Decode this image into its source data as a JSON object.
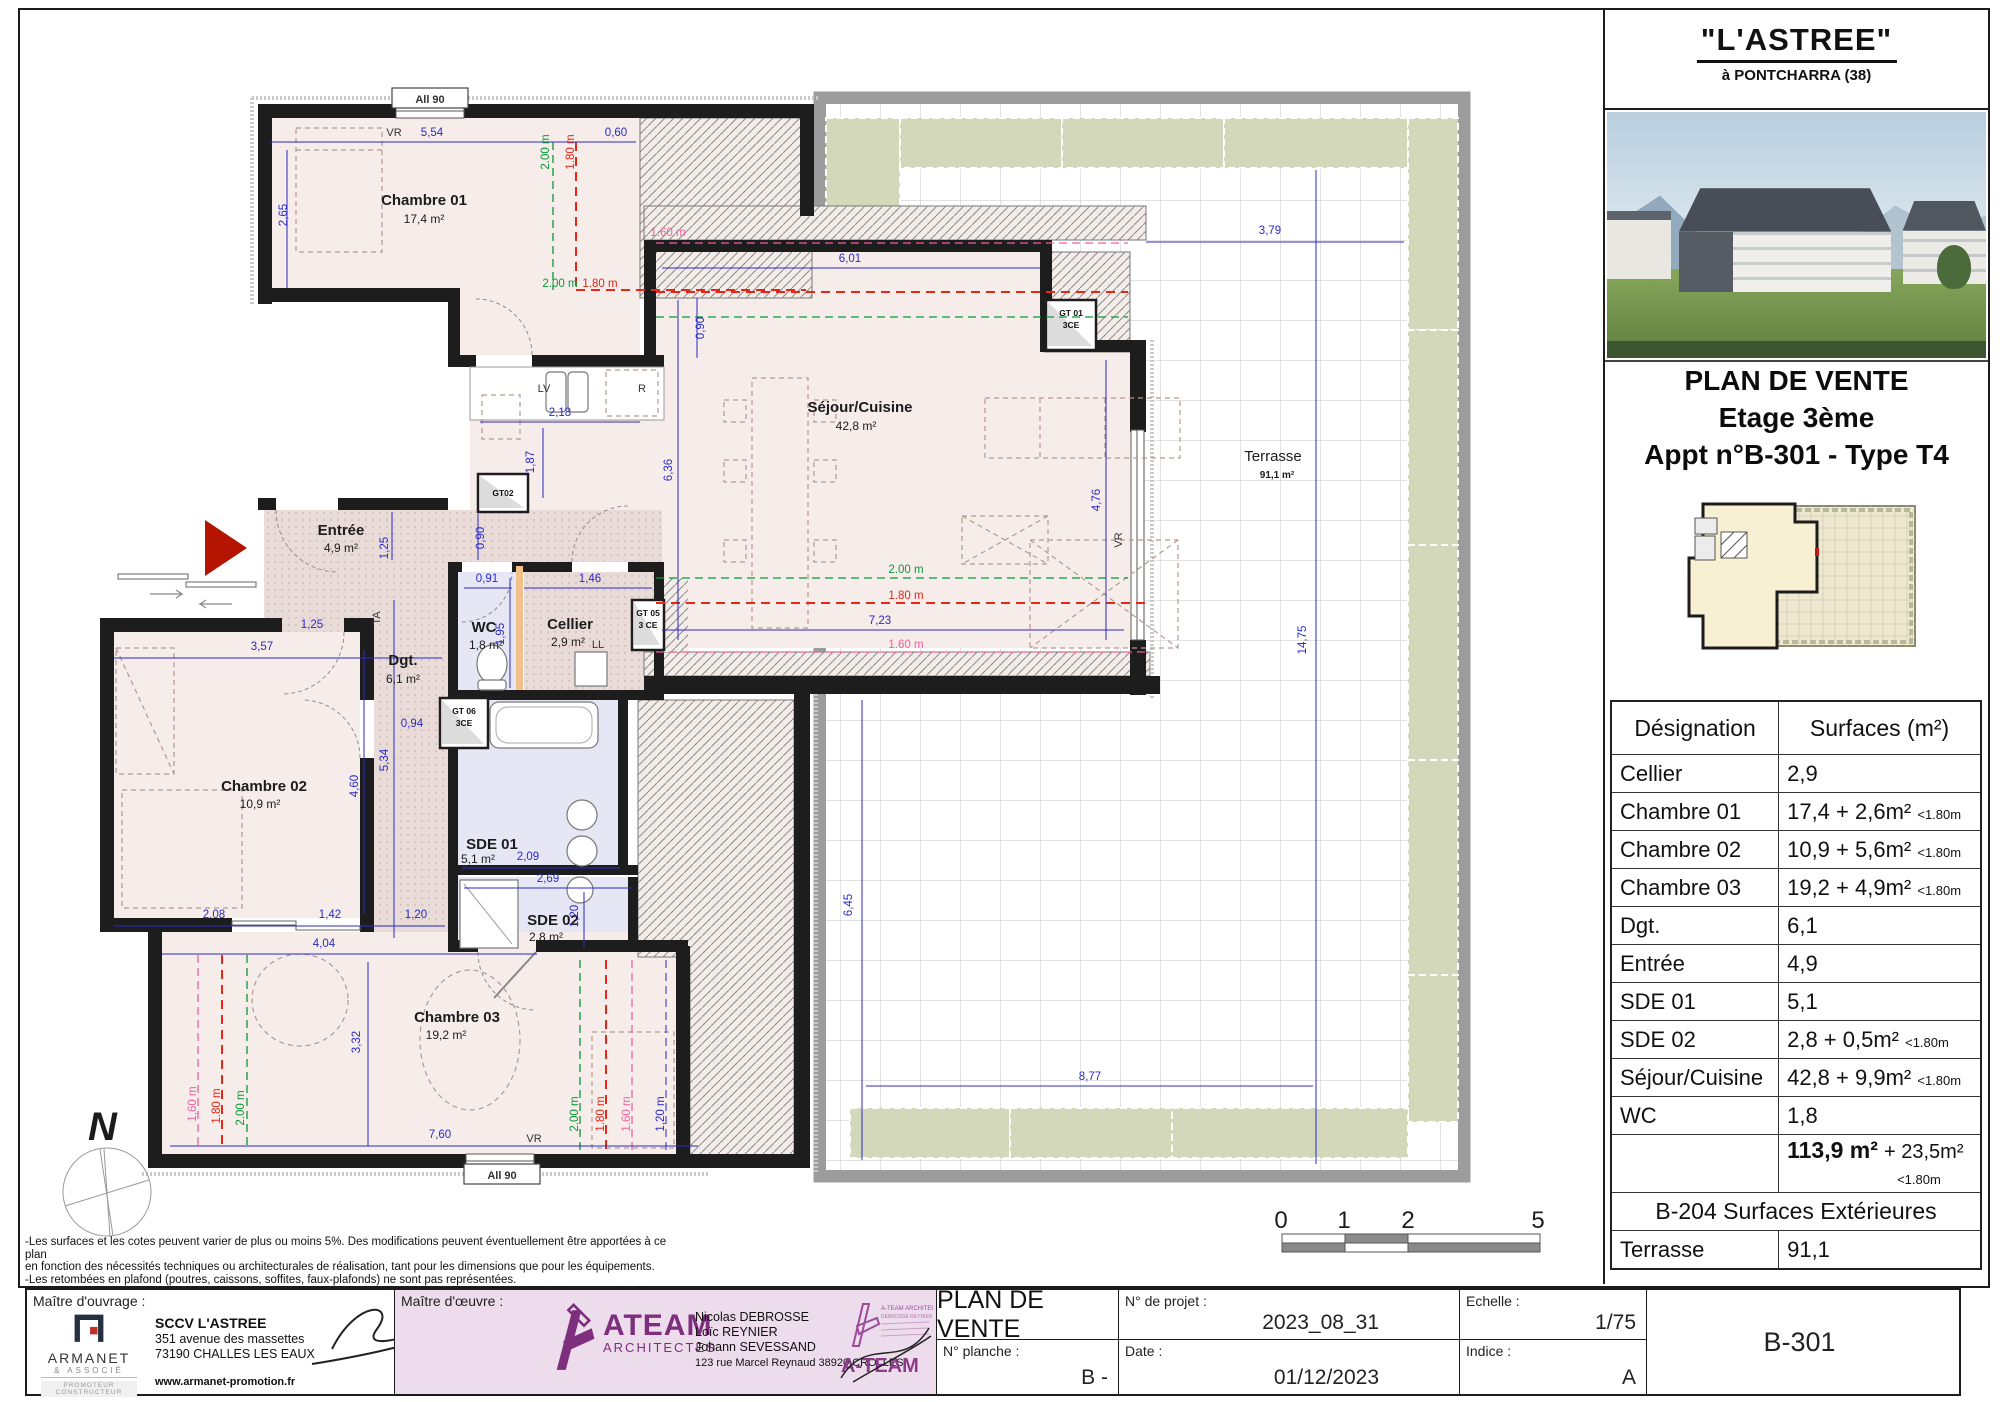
{
  "panel": {
    "header": {
      "title": "\"L'ASTREE\"",
      "subtitle": "à PONTCHARRA (38)"
    },
    "title": {
      "l1": "PLAN DE VENTE",
      "l2": "Etage 3ème",
      "l3": "Appt n°B-301 - Type T4"
    },
    "table": {
      "col1": "Désignation",
      "col2": "Surfaces (m²)",
      "rows": [
        {
          "name": "Cellier",
          "value": "2,9",
          "note": ""
        },
        {
          "name": "Chambre 01",
          "value": "17,4 + 2,6m²",
          "note": "<1.80m"
        },
        {
          "name": "Chambre 02",
          "value": "10,9 + 5,6m²",
          "note": "<1.80m"
        },
        {
          "name": "Chambre 03",
          "value": "19,2 + 4,9m²",
          "note": "<1.80m"
        },
        {
          "name": "Dgt.",
          "value": "6,1",
          "note": ""
        },
        {
          "name": "Entrée",
          "value": "4,9",
          "note": ""
        },
        {
          "name": "SDE 01",
          "value": "5,1",
          "note": ""
        },
        {
          "name": "SDE 02",
          "value": "2,8  + 0,5m²",
          "note": "<1.80m"
        },
        {
          "name": "Séjour/Cuisine",
          "value": "42,8 + 9,9m²",
          "note": "<1.80m"
        },
        {
          "name": "WC",
          "value": "1,8",
          "note": ""
        }
      ],
      "total": {
        "value": "113,9 m²",
        "extra": "+ 23,5m²",
        "note": "<1.80m"
      },
      "section": "B-204 Surfaces Extérieures",
      "ext": {
        "name": "Terrasse",
        "value": "91,1"
      }
    }
  },
  "tb": {
    "mo_label": "Maître d'ouvrage :",
    "mo_company": "SCCV L'ASTREE",
    "mo_addr1": "351 avenue des massettes",
    "mo_addr2": "73190 CHALLES LES EAUX",
    "mo_site": "www.armanet-promotion.fr",
    "armanet": {
      "name": "ARMANET",
      "sub": "& ASSOCIÉ",
      "tag": "PROMOTEUR CONSTRUCTEUR"
    },
    "moe_label": "Maître d'œuvre :",
    "ateam_word": "ATEAM",
    "ateam_sub": "ARCHITECTES",
    "moe_name1": "Nicolas DEBROSSE",
    "moe_name2": "Loïc REYNIER",
    "moe_name3": "Johann SEVESSAND",
    "moe_addr": "123 rue Marcel Reynaud 38920 CROLLES",
    "stamp_line1": "A-TEAM ARCHITECTES",
    "stamp_line2": "DEBROSSE REYNIER SEVESSAND",
    "stamp_word": "A-TEAM",
    "doc_title": "PLAN DE VENTE",
    "project_label": "N° de projet :",
    "project_value": "2023_08_31",
    "sheet_label": "N° planche :",
    "sheet_value": "B -",
    "date_label": "Date :",
    "date_value": "01/12/2023",
    "scale_label": "Echelle :",
    "scale_value": "1/75",
    "index_label": "Indice :",
    "index_value": "A",
    "ref": "B-301"
  },
  "notes": {
    "l1": "-Les surfaces et les cotes peuvent varier de plus ou moins 5%. Des modifications peuvent éventuellement être apportées à ce plan",
    "l2": "en fonction des nécessités techniques ou architecturales de réalisation, tant pour les dimensions que pour les équipements.",
    "l3": "-Les retombées en plafond (poutres, caissons, soffites, faux-plafonds) ne sont pas représentées.",
    "l4": "-Les canalisations et radiateurs sont donnés à titre indicatif, mais ne sont pas contractuels. Des modifications peuvent y être apportées."
  },
  "plan": {
    "rooms": {
      "ch1": {
        "n": "Chambre 01",
        "a": "17,4 m²"
      },
      "sej": {
        "n": "Séjour/Cuisine",
        "a": "42,8 m²"
      },
      "ter": {
        "n": "Terrasse",
        "a": "91,1 m²"
      },
      "ent": {
        "n": "Entrée",
        "a": "4,9 m²"
      },
      "wc": {
        "n": "WC",
        "a": "1,8 m²"
      },
      "cel": {
        "n": "Cellier",
        "a": "2,9 m²"
      },
      "dgt": {
        "n": "Dgt.",
        "a": "6,1 m²"
      },
      "ch2": {
        "n": "Chambre 02",
        "a": "10,9 m²"
      },
      "sde1": {
        "n": "SDE 01",
        "a": "5,1 m²"
      },
      "sde2": {
        "n": "SDE 02",
        "a": "2,8 m²"
      },
      "ch3": {
        "n": "Chambre 03",
        "a": "19,2 m²"
      }
    },
    "dims": {
      "d554": "5,54",
      "d265": "2,65",
      "d060": "0,60",
      "d090a": "0,90",
      "d090b": "0,90",
      "d601": "6,01",
      "d218": "2,18",
      "d187": "1,87",
      "d636": "6,36",
      "d476": "4,76",
      "d379": "3,79",
      "d1475": "14,75",
      "d645": "6,45",
      "d877": "8,77",
      "d723": "7,23",
      "d091": "0,91",
      "d146": "1,46",
      "d195": "1,95",
      "d125v": "1,25",
      "d125h": "1,25",
      "d357": "3,57",
      "d534": "5,34",
      "d460": "4,60",
      "d094": "0,94",
      "d209": "2,09",
      "d269": "2,69",
      "d120s": "1,20",
      "d208": "2,08",
      "d142": "1,42",
      "d120c": "1,20",
      "d404": "4,04",
      "d332": "3,32",
      "d760": "7,60",
      "g1": "2.00 m",
      "g2": "2.00 m",
      "g3": "2.00 m",
      "g4": "2.00 m",
      "g5": "2.00 m",
      "r1": "1.80 m",
      "r2": "1.80 m",
      "r3": "1.80 m",
      "r4": "1.80 m",
      "r5": "1.80 m",
      "p1": "1.60 m",
      "p2": "1.60 m",
      "p3": "1,60 m",
      "p4": "1.60 m",
      "b120": "1,20 m"
    },
    "ann": {
      "vr1": "VR",
      "vr2": "VR",
      "vr3": "VR",
      "ta": "TA",
      "ll": "LL",
      "lv": "LV",
      "r": "R",
      "all90a": "All 90",
      "all90b": "All 90",
      "gt01a": "GT 01",
      "gt01b": "3CE",
      "gt02": "GT02",
      "gt05a": "GT 05",
      "gt05b": "3 CE",
      "gt06a": "GT 06",
      "gt06b": "3CE"
    },
    "scale": {
      "n0": "0",
      "n1": "1",
      "n2": "2",
      "n5": "5"
    },
    "north": "N"
  }
}
